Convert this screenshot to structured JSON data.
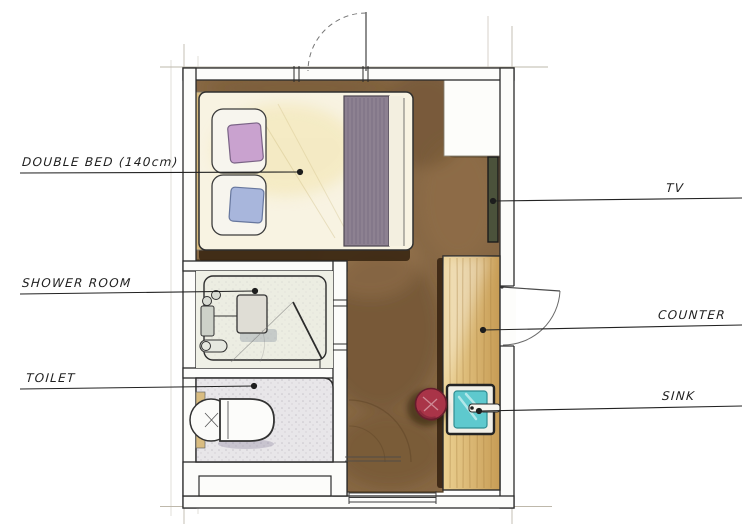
{
  "document": {
    "type": "hand-drawn watercolor floor plan"
  },
  "labels": {
    "double_bed": "DOUBLE BED (140cm)",
    "tv": "TV",
    "shower_room": "SHOWER ROOM",
    "counter": "COUNTER",
    "toilet": "TOILET",
    "sink": "SINK"
  },
  "depicted_elements": [
    "double bed with two pillows and striped blanket",
    "wall-mounted tv panel",
    "wooden counter along right wall",
    "square sink with faucet",
    "round red stool",
    "shower room with seat and glass partition",
    "toilet with tank and bowl",
    "entrance door swing at top wall",
    "side door swing at right wall"
  ],
  "colors": {
    "floor_brown": "#84643f",
    "floor_brown_dark": "#5e4426",
    "shadow_dark": "#3a2712",
    "wood_light": "#ecd191",
    "wood_dark": "#c79c55",
    "headboard_wood": "#d9bc80",
    "tv_green": "#4b523b",
    "pillow_purple": "#c9a2cf",
    "pillow_blue": "#a8b6dc",
    "blanket_mauve": "#8d8191",
    "bed_cream": "#f2e3a8",
    "sink_teal": "#5ec9ce",
    "stool_red": "#a93448",
    "ink": "#2e2e2e"
  }
}
